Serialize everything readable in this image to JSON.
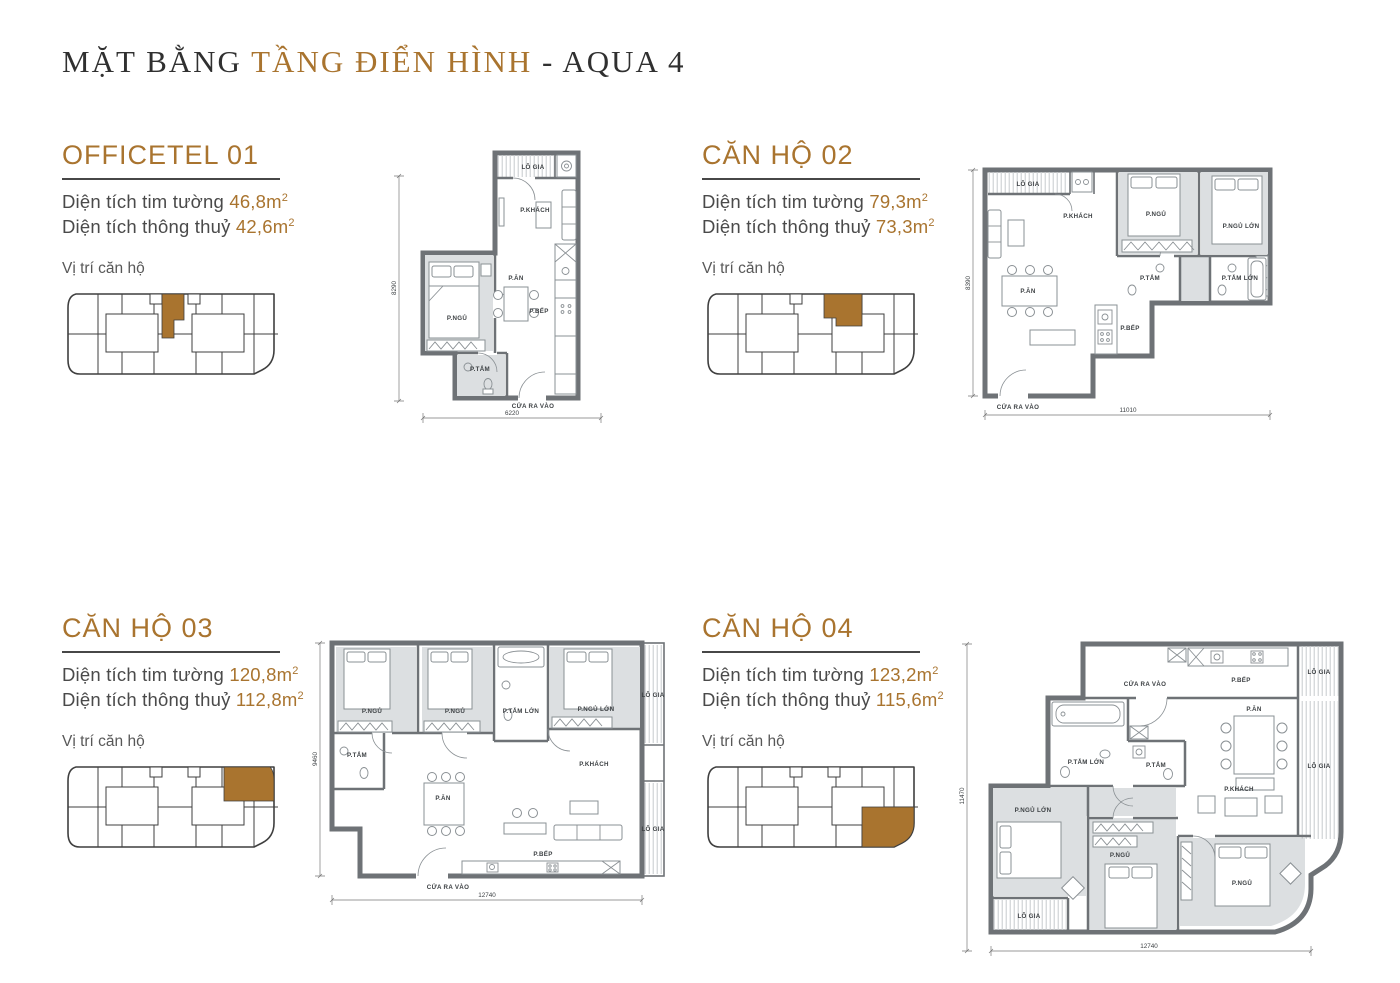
{
  "page": {
    "title_prefix": "MẶT BẰNG",
    "title_accent": "TẦNG ĐIỂN HÌNH",
    "title_suffix": "- AQUA 4"
  },
  "labels": {
    "tim_tuong": "Diện tích tim tường",
    "thong_thuy": "Diện tích thông thuỷ",
    "vi_tri": "Vị trí căn hộ",
    "sup": "2"
  },
  "colors": {
    "accent": "#A9742F",
    "dark": "#303030",
    "text": "#4A4A4A",
    "wall": "#6E7276",
    "room-fill": "#DCDFE1",
    "line": "#8A9094"
  },
  "units": [
    {
      "name": "OFFICETEL 01",
      "area_tim": "46,8m",
      "area_thong": "42,6m",
      "plan": {
        "lo_gia": "LÔ GIA",
        "khach": "P.KHÁCH",
        "ngu": "P.NGỦ",
        "an": "P.ĂN",
        "bep": "P.BẾP",
        "tam": "P.TẮM",
        "entrance": "CỬA RA VÀO",
        "dim_w": "6220",
        "dim_h": "8290"
      }
    },
    {
      "name": "CĂN HỘ 02",
      "area_tim": "79,3m",
      "area_thong": "73,3m",
      "plan": {
        "lo_gia": "LÔ GIA",
        "khach": "P.KHÁCH",
        "ngu": "P.NGỦ",
        "ngu_lon": "P.NGỦ LỚN",
        "an": "P.ĂN",
        "tam": "P.TẮM",
        "tam_lon": "P.TẮM LỚN",
        "bep": "P.BẾP",
        "entrance": "CỬA RA VÀO",
        "dim_w": "11010",
        "dim_h": "8390"
      }
    },
    {
      "name": "CĂN HỘ 03",
      "area_tim": "120,8m",
      "area_thong": "112,8m",
      "plan": {
        "ngu_a": "P.NGỦ",
        "ngu_b": "P.NGỦ",
        "tam_lon": "P.TẮM LỚN",
        "ngu_lon": "P.NGỦ LỚN",
        "lo_gia_top": "LÔ GIA",
        "lo_gia_bottom": "LÔ GIA",
        "tam": "P.TẮM",
        "khach": "P.KHÁCH",
        "an": "P.ĂN",
        "bep": "P.BẾP",
        "entrance": "CỬA RA VÀO",
        "dim_w": "12740",
        "dim_h": "9460"
      }
    },
    {
      "name": "CĂN HỘ 04",
      "area_tim": "123,2m",
      "area_thong": "115,6m",
      "plan": {
        "entrance": "CỬA RA VÀO",
        "bep": "P.BẾP",
        "lo_gia_top": "LÔ GIA",
        "an": "P.ĂN",
        "tam_lon": "P.TẮM LỚN",
        "tam": "P.TẮM",
        "khach": "P.KHÁCH",
        "lo_gia_right": "LÔ GIA",
        "ngu_lon": "P.NGỦ LỚN",
        "ngu_a": "P.NGỦ",
        "ngu_b": "P.NGỦ",
        "lo_gia_bottom": "LÔ GIA",
        "dim_w": "12740",
        "dim_h": "11470"
      }
    }
  ]
}
